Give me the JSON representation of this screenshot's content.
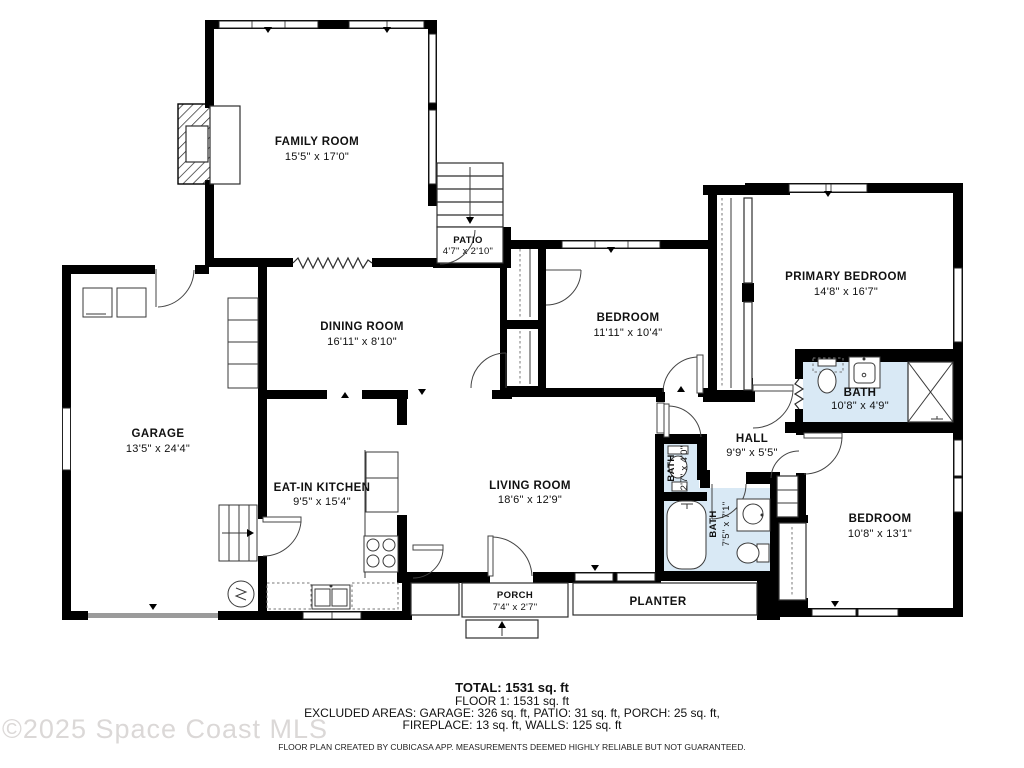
{
  "watermark": "©2025 Space Coast MLS",
  "rooms": {
    "family_room": {
      "name": "FAMILY ROOM",
      "dims": "15'5\" x 17'0\""
    },
    "patio": {
      "name": "PATIO",
      "dims": "4'7\" x 2'10\""
    },
    "dining_room": {
      "name": "DINING ROOM",
      "dims": "16'11\" x 8'10\""
    },
    "bedroom_middle": {
      "name": "BEDROOM",
      "dims": "11'11\" x 10'4\""
    },
    "primary_bedroom": {
      "name": "PRIMARY BEDROOM",
      "dims": "14'8\" x 16'7\""
    },
    "primary_bath": {
      "name": "BATH",
      "dims": "10'8\" x 4'9\""
    },
    "garage": {
      "name": "GARAGE",
      "dims": "13'5\" x 24'4\""
    },
    "eat_in_kitchen": {
      "name": "EAT-IN KITCHEN",
      "dims": "9'5\" x 15'4\""
    },
    "living_room": {
      "name": "LIVING ROOM",
      "dims": "18'6\" x 12'9\""
    },
    "hall": {
      "name": "HALL",
      "dims": "9'9\" x 5'5\""
    },
    "water_closet": {
      "name": "BATH",
      "dims": "2'7\" x 4'0\""
    },
    "hall_bath": {
      "name": "BATH",
      "dims": "7'5\" x 7'1\""
    },
    "bedroom_bottom": {
      "name": "BEDROOM",
      "dims": "10'8\" x 13'1\""
    },
    "porch": {
      "name": "PORCH",
      "dims": "7'4\" x 2'7\""
    },
    "planter": {
      "name": "PLANTER"
    }
  },
  "summary": {
    "total": "TOTAL: 1531 sq. ft",
    "floor": "FLOOR 1: 1531 sq. ft",
    "excluded_line1": "EXCLUDED AREAS: GARAGE: 326 sq. ft, PATIO: 31 sq. ft, PORCH: 25 sq. ft,",
    "excluded_line2": "FIREPLACE: 13 sq. ft, WALLS: 125 sq. ft",
    "disclaimer": "FLOOR PLAN CREATED BY CUBICASA APP. MEASUREMENTS DEEMED HIGHLY RELIABLE BUT NOT GUARANTEED."
  },
  "colors": {
    "wall": "#000000",
    "bath_fill": "#d9e9f5",
    "garage_door": "#9b9b9b",
    "watermark_text": "#dbd8d7"
  }
}
